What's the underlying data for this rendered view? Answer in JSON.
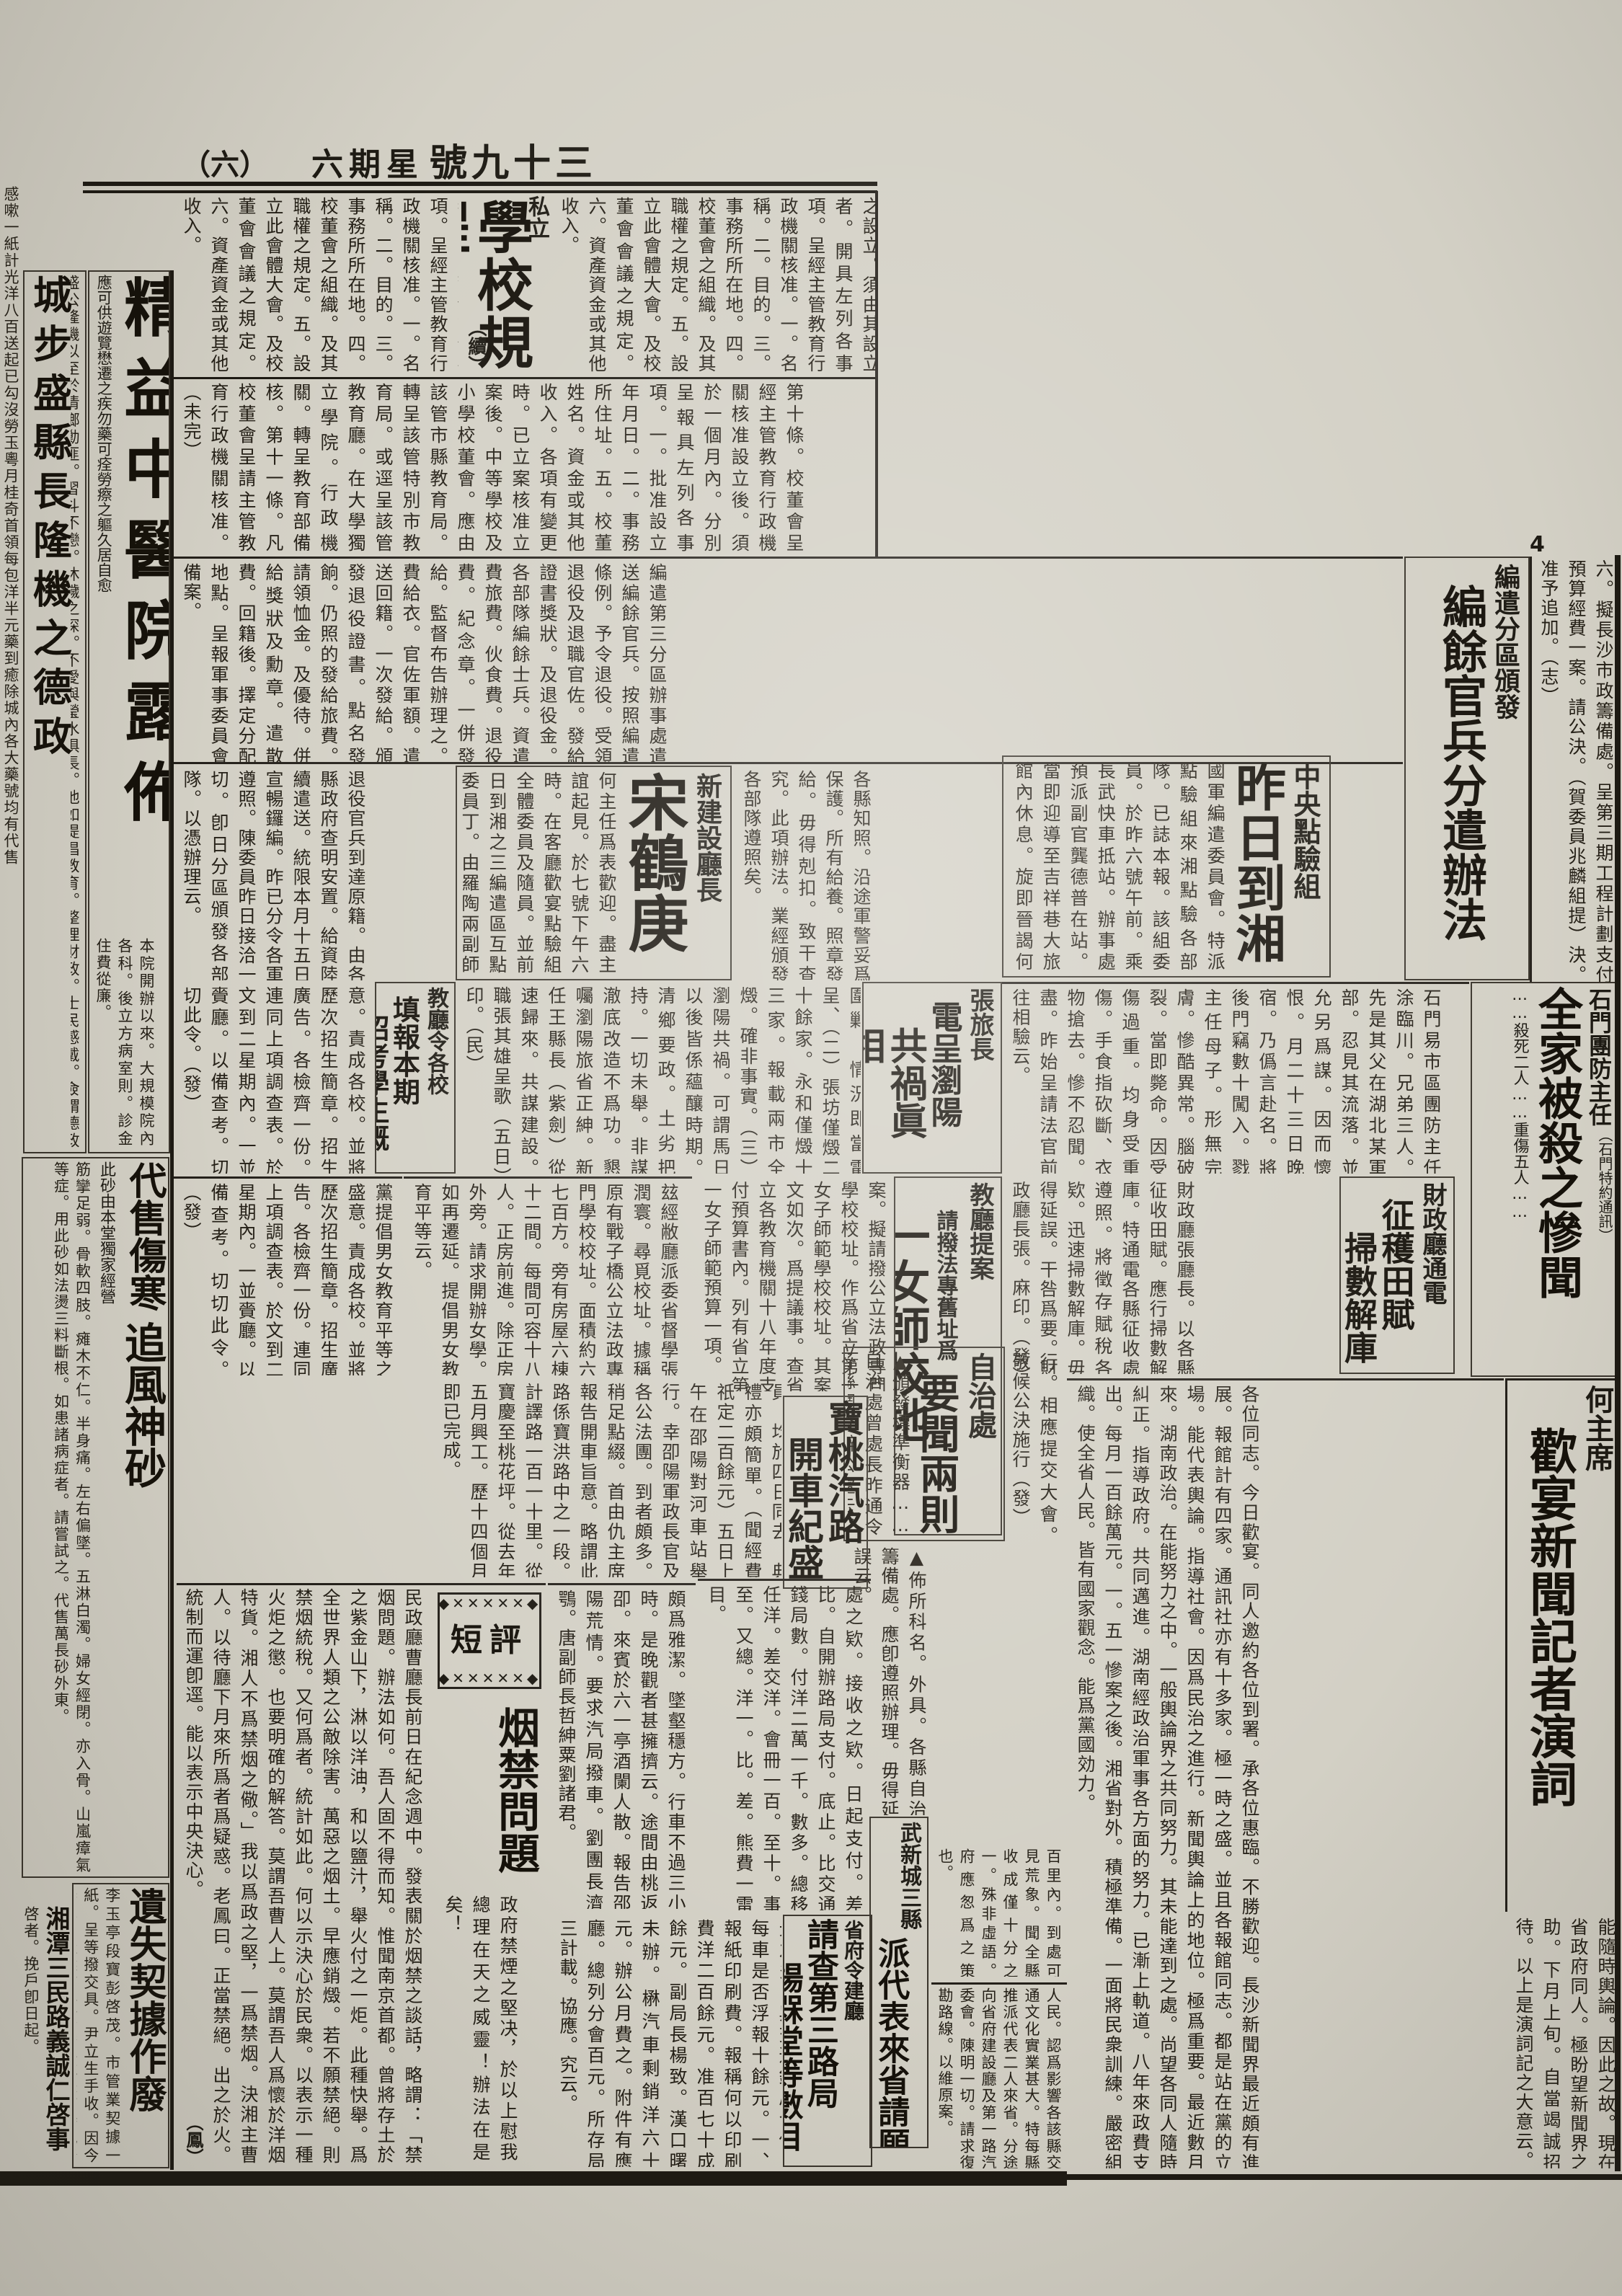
{
  "masthead": {
    "page_num": "（六）",
    "weekday": "六期星",
    "issue_no": "號九十三",
    "folio_mark": "4"
  },
  "colors": {
    "paper": "#d3d0c5",
    "ink": "#1d1a13"
  },
  "articles": {
    "edge_strip": {
      "body": "感嗽一紙計光洋八百送起已勾沒勞玉粵月桂奇首領每包洋半元藥到癒除城內各大藥號均有代售"
    },
    "chengbu": {
      "title": "城步盛縣長隆機之德政",
      "body": "盛公隆機以至於清鄉勦匪。習斗不戀。沐穢之深。不愛與瑩水俱長。他如提倡教育。整理財政。士民感戴。僉謂德政云。"
    },
    "jingyi": {
      "title": "精益中醫院露佈",
      "side_note": "應可供遊覽懋遷之疾勿藥可痊勞瘵之軀久居自愈",
      "body": "本院開辦以來。大規模院內各科。後立方病室則。診金住費從廉。"
    },
    "regulations": {
      "kicker": "私立",
      "title": "學校規程",
      "cont_mark": "（續）",
      "body1": "第六條。私立學校辦理不善。或違背法令時。主管教育行政機關。得撤銷其立案或解散之。第七條。私立學校之名稱。應明確標示學校之種類。並須冠以私立二字。第二章。校董會。第八條。私立學校以校董會爲其設立者之代表。負經營學校之全責。第九條。校董會之設立。須由其設立者。開具左列各事項。呈經主管教育行政機關核准。一。名稱。二。目的。三。事務所所在地。四。校董會之組織。及其職權之規定。五。設立此會體大會。及校董會會議之規定。六。資產資金或其他收入。",
      "body2": "第十條。校董會呈經主管教育行政機關核准設立後。須於一個月內。分別呈報具左列各事項。一。批准設立年月日。二。事務所住址。五。校董姓名。資金或其他收入。各項有變更時。已立案核准立案後。中等學校及小學校董會。應由該管市縣教育局。轉呈該管特別市教育局。或逕呈該管教育廳。在大學獨立學院。行政機關。轉呈教育部備核。第十一條。凡校董會呈請主管教育行政機關核准。（未完）"
    },
    "council": {
      "body": "照准。五。擬請委任譚瑛宋實秋爲祕書。陳容爲總設廳第一科科長。可否請公決。（志）照委。六。擬長沙市政籌備處。呈第三期工程計劃支付預算經費一案。請公決。（賀委員兆麟組提）決。准予追加。（志）"
    },
    "demob": {
      "kicker": "編遣分區頒發",
      "title": "編餘官兵分遣辦法",
      "body": "編遣第三分區辦事處遣送編餘官兵。按照編遣條例。予令退役。受領退役及退職官佐。發給證書獎狀。及退役金。各部隊編餘士兵。資遣費旅費。伙食費。退役費。紀念章。一併發給。監督布告辦理之。費給衣。官佐軍額。遣送回籍。一次發給。頒發退役證書。點名發餉。仍照的發給旅費。請領恤金。及優待。併給獎狀及勳章。遣散費。回籍後。擇定分配地點。呈報軍事委員會備案。"
    },
    "demob_cont_left": {
      "body": "退役官兵到達原籍。由各縣政府查明安置。給資陸續遣送。統限本月十五日宣暢鑼編。昨已分令各軍遵照。陳委員昨日接洽一切。卽日分區頒發各部隊。以憑辦理云。"
    },
    "demob_cont_mid": {
      "body": "各縣知照。沿途軍警妥爲保護。所有給養。照章發給。毋得剋扣。致干查究。此項辦法。業經頒發各部隊遵照矣。"
    },
    "inspection": {
      "kicker": "中央點驗組",
      "title": "昨日到湘",
      "body": "國軍編遣委員會。特派點驗組來湘點驗各部隊。已誌本報。該組委員。於昨六號午前。乘長武快車抵站。辦事處預派副官龔德普在站。當即迎導至吉祥巷大旅館內休息。旋即晉謁何主任。有所協商。玆調查其委員如次。（一）中央組組長伍崇仁（號壽卿）組長王者師（聘君）委員兆麟（伯烈）都銘（子）劉鎮國（松軒）（二）"
    },
    "song": {
      "kicker": "新建設廳長",
      "title": "宋鶴庚",
      "body": "何主任爲表歡迎。盡主誼起見。於七號下午六時。在客廳歡宴點驗組全體委員及隨員。並前日到湘之三編遣區互點委員丁。由羅陶兩副師長。郭副旅長（漊）郭劉旅長等作陪云。（民）"
    },
    "shimen": {
      "kicker": "石門團防主任",
      "title": "全家被殺之慘聞",
      "subtitle": "……殺死二人……重傷五人……",
      "note": "（石門特約通訊）",
      "body": "石門易市區團防主任涂臨川。兄弟三人。先是其父在湖北某軍部。忍見其流落。並允另爲謀。因而懷恨。月二十三日晚宿。乃僞言赴名。將後門竊數十闖入。戮主任母子。形無完膚。慘酷異常。腦破裂。當即斃命。因受傷過重。均身受重傷。手食指砍斷、衣物搶去。慘不忍聞。盡。昨始呈請法官前往相驗云。"
    },
    "finance": {
      "kicker": "財政廳通電",
      "title1": "征穫田賦",
      "title2": "掃數解庫",
      "body": "財政廳張廳長。以各縣征收田賦。應行掃數解庫。特通電各縣征收處遵照。將徵存賦稅各欵。迅速掃數解庫。毋得延誤。干咎爲要。財政廳長張。麻印。（發）"
    },
    "he_speech": {
      "kicker": "何主席",
      "title": "歡宴新聞記者演詞",
      "body": "各位同志。今日歡宴。同人邀約各位到署。承各位惠臨。不勝歡迎。長沙新聞界最近頗有進展。報館計有四家。通訊社亦有十多家。極一時之盛。並且各報館同志。都是站在黨的立場。能代表輿論。指導社會。因爲民治之進行。新聞輿論上的地位。極爲重要。最近數月來。湖南政治。在能努力之中。一般輿論界之共同努力。其未能達到之處。尚望各同人隨時糾正。指導政府。共同邁進。湖南經政治軍事各方面的努力。已漸上軌道。八年來政費支出。每月一百餘萬元。一。五一慘案之後。湘省對外。積極準備。一面將民衆訓練。嚴密組織。使全省人民。皆有國家觀念。能爲黨國効力。",
      "body2": "能隨時輿論。因此之故。現在省政府同人。極盼望新聞界之助。下月上旬。自當竭誠招待。以上是演詞記之大意云。"
    },
    "zhang": {
      "kicker": "張旅長",
      "title1": "電呈瀏陽",
      "title2": "共禍眞相",
      "body": "△張坊永和兩市未全燬△土劣把持清鄉要政△團長圍剿丙尖嶺匪巢。張旅長其雄。昨由瀏陽來電云。（銜略）鈞鑒。（一）丙尖嶺匪巢。已由張團長圍剿。情況即當電呈、（二）張坊僅燬二十餘家。永和僅燬十三家。報載兩市全燬。確非事實。（三）瀏陽共禍。可謂馬日以後皆係蘊釀時期。清鄉要政。土劣把持。一切未舉。非謀澈底改造不爲功。懇囑瀏陽旅省正紳。新任王縣長（紫劍）從速歸來。共謀建設。職張其雄呈歌（五日）印。（民）"
    },
    "order": {
      "kicker": "教廳令各校",
      "title1": "填報本期",
      "title2": "招考學生概况",
      "body": "查各校招考學生。近因各中學畢業者日多。中央規定中等學校准男女同校。致使女生無處升學。紛至踏來。殊乖本黨提倡男女教育平等之盛意。責成各校。並將歷次招生簡章。招生廣告。各檢齊一份。連同上項調查表。於文到二星期內。一並賫廳。以備查考。切切此令。（發）",
      "body2": "玆經敝廳派委省督學張潤寰。尋覓校址。據稱原有戰子橋公立法政專門學校校址。面積約六七百方。旁有房屋六棟十二間。每間可容十八人。正房前進。除正房外旁。請求開辦女學。如再遷延。提倡男女教育平等云。"
    },
    "proposal": {
      "kicker": "教廳提案",
      "subtitle": "請撥法專舊址爲",
      "title": "一女師校地",
      "body": "黃教長。昨向省府會議提案。擬請撥公立法政專門學校校址。作爲省立第一女子師範學校校址。其案文如次。爲提議事。查省立各教育機關十八年度支付預算書內。列有省立第一女子師範預算一項。",
      "body2": "此女師校址有着。該院亦無妨碍。是否可行。相應提交大會。敬候公決施行（發）"
    },
    "zizhichu": {
      "kicker": "自治處",
      "title": "要聞兩則",
      "body": "▲頒發標準衡器……自治處曾處長昨通令各縣調查辦公處云。爲通令事。查調查度量衡。應需之標準衡器。現已頒發各縣。",
      "body2": "▲佈所科名。外具。各縣自治籌備處。應卽遵照辦理。毋得延誤云。"
    },
    "baotao": {
      "title1": "寶桃汽路",
      "title2": "開車紀盛",
      "body": "寶桃汽車路。定於五日行開車禮。該局先期帖請各機關領袖。赴寶參與盛典。乃四日赴寶者。除財政廳之黃夢遂劉約眞兩祕書外。未見一人。即主管機關之建設廳亦不派一人參加。較諸去歲潭寶路開車。殊爲寂寞。該局仇局長周梁兩課長。與委員會董璋元誼之祝澄清諸委員。均於四日同去。典禮亦頗簡單。（聞經費祇定二百餘元）五日上午在邵陽對河車站舉行。幸卲陽軍政長官及各公法團。到者頗多。稍足點綴。首由仇主席報告開車旨意。略謂此路係寶洪路中之一段。計譯路一百一十里。從寶慶至桃花坪。從去年五月興工。歷十四個月即已完成。",
      "body2": "沿途所經。許多小橋。均青石砌成。頗爲雅潔。墜壑穩方。行車不過三小時。是晚觀者甚擁擠云。途間由桃返卲。來賓於六一亭酒闌人散。報告邵陽荒情。要求汽局撥車。劉團長濟鶚。唐副師長哲紳粟劉諸君。",
      "body3": "雖參加開車盛典。自界爲邵陽勘荒。桃花坪數百里內。到處可見荒象。聞全縣收成僅十分之一。殊非虛語。府應怱爲之策也。"
    },
    "duanping": {
      "box_label": "短評",
      "ornament_top": "◆✕✕✕✕✕◆",
      "ornament_bottom": "◆✕✕✕✕✕◆",
      "headline": "烟禁問題",
      "body": "民政廳曹廳長前日在紀念週中。發表關於烟禁之談話，略謂：「禁烟問題。辦法如何。吾人固不得而知。惟聞南京首都。曾將存土於之紫金山下，淋以洋油，和以鹽汁，舉火付之一炬。此種快舉。爲全世界人類之公敵除害。萬惡之烟土。早應銷燬。若不願禁絕。則禁烟統稅。又何爲者。統計如此。何以示決心於民衆。以表示一種火炬之懲。也要明確的解答。莫謂吾曹人上。莫謂吾人爲懷於洋烟特貨。湘人不爲禁烟之儆。」我以爲政之堅，一爲禁烟。決湘主曹人。以待廳下月來所爲者爲疑惑。老鳳曰。正當禁絕。出之於火。統制而運卽逕。能以表示中央決心。",
      "sig": "（鳳）",
      "closing": "政府禁煙之堅决，於以上慰我總理在天之威靈！辦法在是矣！"
    },
    "audit_table": {
      "body": "理。交通錢局存數比較。十餘元欵。處之欵。接收之欵。日起支付。差比。自開辦路局支付。底止。比交通錢局數。付洋二萬一千。數多。總移任洋。差交洋。會冊一百。至十。事至。又總。洋一。比。差。熊費一雷目。"
    },
    "shengfu": {
      "kicker": "省府令建廳",
      "title1": "請查第三路局",
      "title2": "楊槑堂等數目",
      "body": "省府以第三路局楊槑堂等經手欵目。不無浮濫。特令建設廳嚴查具復。計開。一、七年元月十四日結交通錢賬。出光洋三萬二千二百八十餘元。一、力車九輛油漆。與雷比先前煞費一百餘元之多。與交通錢局合併。每車是否浮報十餘元。一、報紙印刷費。報稱何以印刷費洋二百餘元。准百七十成餘元。副局長楊致。漢口曙未辦。楙汽車剩銷洋六十元。辦公月費之。附件有應廳。總列分會百元。所存局三計載。協應。究云。"
    },
    "wuxincheng": {
      "kicker": "武新城三縣",
      "title": "派代表來省請願",
      "body": "桃樹坪王靜潭領一段。即繼續興修。以符第四屆路務代表會原案。乃路線忽有變更。不經龍潭舖。將改經和尚橋等處。該三縣人民。認爲影響各該縣交通文化實業甚大。特每縣推派代表二人來省。分途向省府建設廳及第一路汽委會。陳明一切。請求復勘路線。以維原案。"
    },
    "med_ad": {
      "title_top": "代售傷寒",
      "title_main": "追風神砂",
      "note": "此砂由本堂獨家經營",
      "body": "筋攣足弱。骨軟四肢。瘫木不仁。半身痛。左右偏墜。五淋白濁。婦女經閉。亦入骨。山嵐瘴氣等症。用此砂如法燙三料斷根。如患諸病症者。請嘗試之。代售萬長砂外東。"
    },
    "lost_deed": {
      "title": "遺失契據作廢",
      "body": "李玉亭段寶彭啓茂。市管業契據一紙。呈等撥交具。尹立生手收。因今春二月擬選。將該契據遺失。特此登報聲明。送交尹立生處。面當致謝。如隱匿不交。嗣後發現。契據作爲廢紙。"
    },
    "xiangtan": {
      "title": "湘潭三民路義誠仁啓事",
      "body": "啓者。挽戶卽日起。"
    }
  }
}
